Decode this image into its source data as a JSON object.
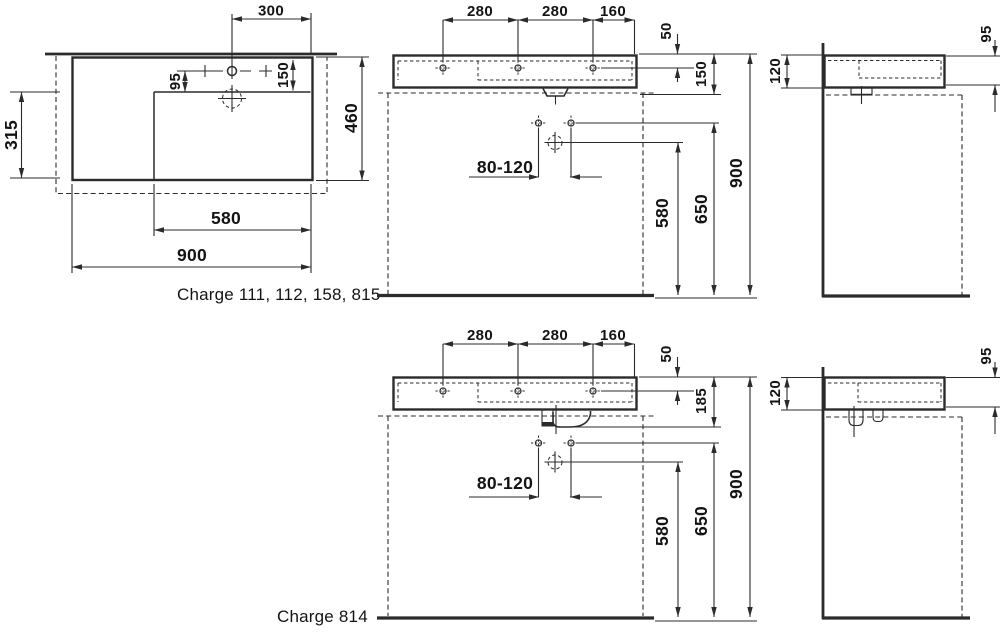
{
  "drawing": {
    "title": "Washbasin technical dimension drawing",
    "group1": {
      "caption": "Charge 111, 112, 158, 815",
      "plan": {
        "tap_to_edge": "300",
        "bowl_depth": "315",
        "tap_to_bowl": "95",
        "rim_to_bowl": "150",
        "depth": "460",
        "bowl_width": "580",
        "width": "900"
      },
      "front": {
        "spacing_left": "280",
        "spacing_mid": "280",
        "spacing_right": "160",
        "rim_to_holes": "50",
        "rim_to_outlet": "150",
        "supply_spacing": "80-120",
        "drain_height": "580",
        "supply_height": "650",
        "rim_height": "900"
      },
      "side": {
        "back_height": "120",
        "front_height": "95"
      }
    },
    "group2": {
      "caption": "Charge 814",
      "front": {
        "spacing_left": "280",
        "spacing_mid": "280",
        "spacing_right": "160",
        "rim_to_holes": "50",
        "rim_to_outlet": "185",
        "supply_spacing": "80-120",
        "drain_height": "580",
        "supply_height": "650",
        "rim_height": "900"
      },
      "side": {
        "back_height": "120",
        "front_height": "95"
      }
    }
  }
}
